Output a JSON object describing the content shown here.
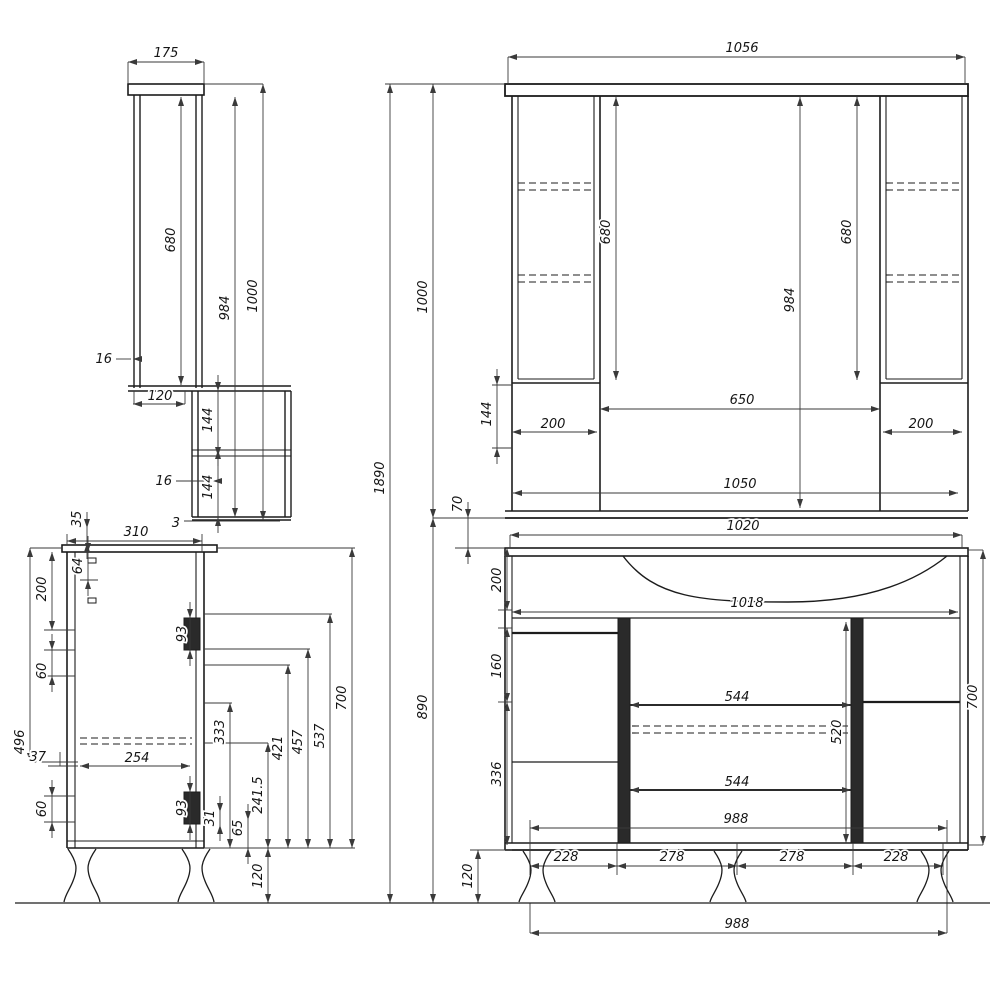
{
  "style": {
    "line_color": "#1c1c1c",
    "dim_color": "#3a3a3a",
    "background": "#ffffff"
  },
  "dimensions": {
    "overall": {
      "total_height": "1890",
      "mirror_section": "1000",
      "base_section": "890"
    },
    "mirror_side": {
      "width": "175",
      "mirror_height": "680",
      "back_height": "984",
      "total_height": "1000",
      "panel_16_top": "16",
      "shelf_depth": "120",
      "gap_144_top": "144",
      "panel_16_mid": "16",
      "gap_144_bottom": "144",
      "bottom_3": "3"
    },
    "mirror_front": {
      "total_width": "1056",
      "left_col_height": "680",
      "center_height": "984",
      "right_col_height": "680",
      "left_col_width": "200",
      "center_width": "650",
      "right_col_width": "200",
      "left_gap_144": "144",
      "bottom_width": "1050",
      "gap_70": "70"
    },
    "base_side": {
      "depth": "310",
      "overhang_35": "35",
      "h200": "200",
      "h64": "64",
      "h60_top": "60",
      "h496": "496",
      "h37": "37",
      "runner_254": "254",
      "h60_bottom": "60",
      "slide_93_top": "93",
      "slide_93_bottom": "93",
      "h31": "31",
      "h65": "65",
      "h241_5": "241.5",
      "legs_120": "120",
      "h333": "333",
      "h421": "421",
      "h457": "457",
      "h537": "537",
      "height_700": "700"
    },
    "base_front": {
      "top_width": "1020",
      "basin_width": "1018",
      "h200": "200",
      "h160": "160",
      "h336": "336",
      "mid_544_top": "544",
      "mid_544_bottom": "544",
      "h520": "520",
      "inner_988": "988",
      "s228_left": "228",
      "s278_left": "278",
      "s278_right": "278",
      "s228_right": "228",
      "legs_120": "120",
      "bottom_988": "988",
      "height_700": "700"
    }
  }
}
